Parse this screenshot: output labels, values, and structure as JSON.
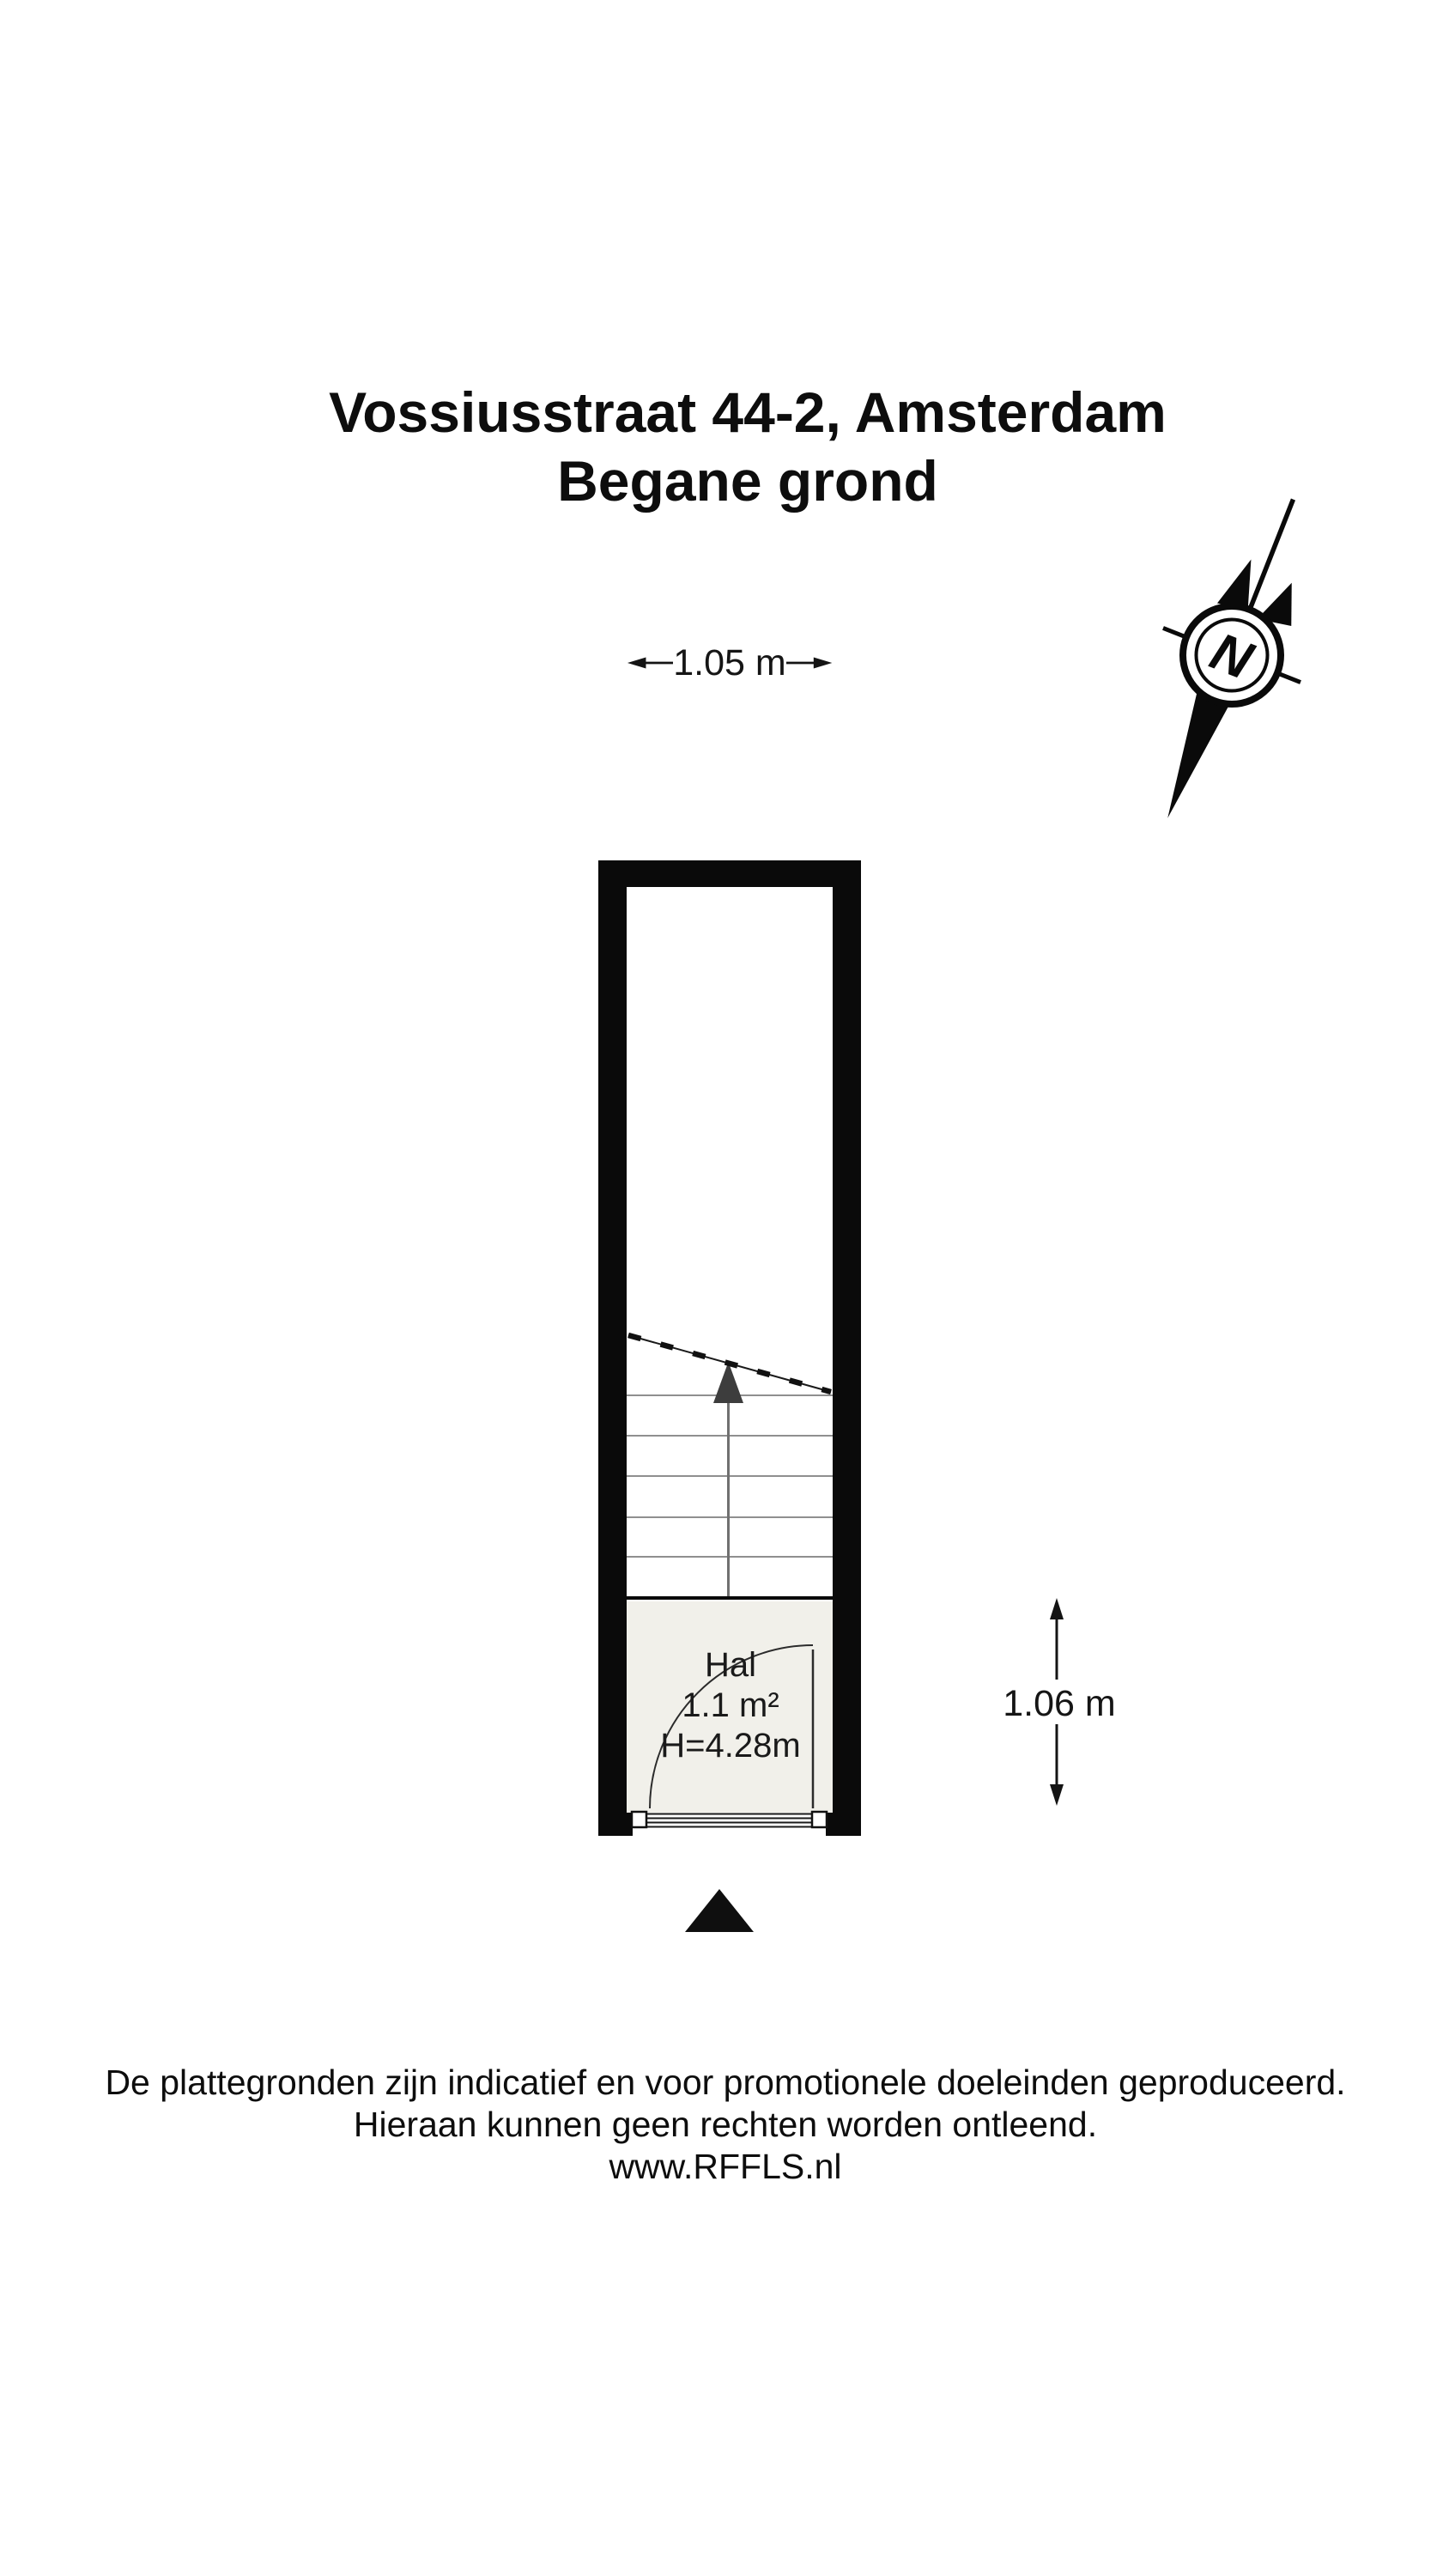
{
  "title": {
    "line1": "Vossiusstraat 44-2, Amsterdam",
    "line2": "Begane grond"
  },
  "dimensions": {
    "width_label": "1.05 m",
    "height_label": "1.06 m"
  },
  "compass": {
    "letter": "N"
  },
  "floor_plan": {
    "room": {
      "name": "Hal",
      "area": "1.1 m²",
      "ceiling_height": "H=4.28m"
    },
    "stairs": {
      "tread_count": 5
    }
  },
  "colors": {
    "wall": "#0a0a0a",
    "room_floor": "#f1f0ea",
    "tread_line": "#8f8f8f",
    "stair_marker": "#3d3d3d",
    "door_line": "#2b2b2b",
    "background": "#ffffff"
  },
  "footer": {
    "line1": "De plattegronden zijn indicatief en voor promotionele doeleinden geproduceerd.",
    "line2": "Hieraan kunnen geen rechten worden ontleend.",
    "line3": "www.RFFLS.nl"
  }
}
